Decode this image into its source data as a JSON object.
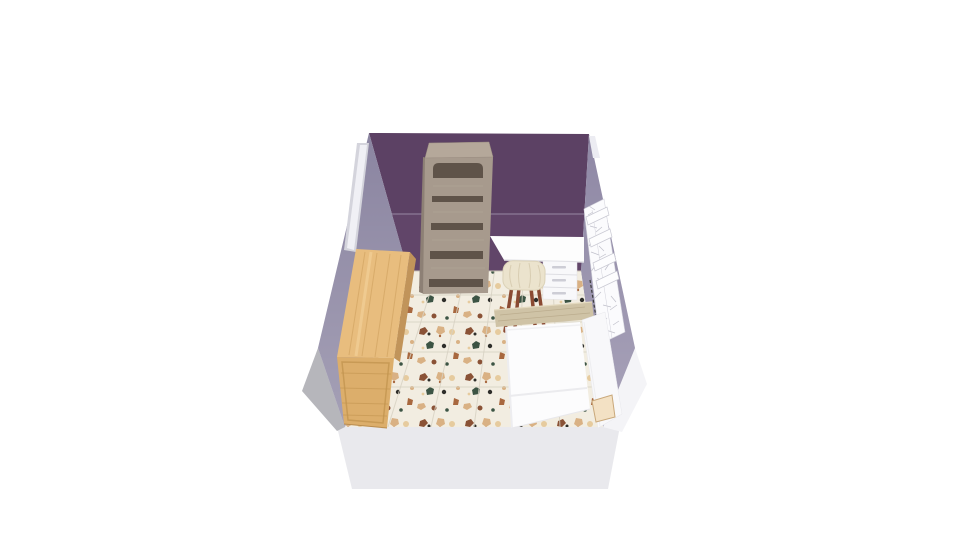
{
  "scene": {
    "description": "3D room-planner perspective view of a small bedroom seen from above, on a white canvas",
    "room": {
      "back_wall": "dark purple accent wall with horizontal trim line",
      "side_walls": "muted grey-lavender",
      "floor": "terrazzo tile with brown, tan, peach and green speckles",
      "front_wall": "white cutaway wall facing the camera"
    },
    "objects": [
      {
        "id": "door",
        "label": "white door on left wall near back corner"
      },
      {
        "id": "dresser",
        "label": "tall light-oak dresser against left wall"
      },
      {
        "id": "bookshelf",
        "label": "tall taupe bookshelf against back wall"
      },
      {
        "id": "desk",
        "label": "white desk with three-drawer unit against back wall"
      },
      {
        "id": "stool",
        "label": "cream upholstered stool with wooden legs"
      },
      {
        "id": "bed",
        "label": "white single bed with wooden headboard and foot"
      },
      {
        "id": "wall-shelf",
        "label": "white sketched shelf unit on right wall with boxes on top"
      }
    ],
    "colors": {
      "background": "#ffffff",
      "back_wall": "#5c4164",
      "back_wall_lower": "#614569",
      "back_wall_trim": "#8d7b97",
      "side_wall_left": "#8b85a1",
      "side_wall_right": "#8f88a5",
      "front_wall": "#e9e9ed",
      "front_wall_left_shade": "#b6b6bb",
      "front_wall_right_light": "#f4f4f7",
      "floor_base": "#f2ede1",
      "door_frame": "#d4d4dc",
      "door_panel": "#f0f0f5",
      "corner_strip": "#ececf2",
      "bookshelf_front": "#a79a8d",
      "bookshelf_top": "#b5a89a",
      "bookshelf_side": "#8d8075",
      "bookshelf_opening": "#5f5349",
      "dresser_top": "#e8bd7e",
      "dresser_front": "#dcae6b",
      "dresser_side": "#c1945a",
      "desk_top": "#fdfdfd",
      "drawer_unit": "#f8f8fa",
      "drawer_handle": "#cdcdd5",
      "stool_seat": "#ebe3cd",
      "stool_leg": "#8a4a32",
      "bed_headboard": "#cfc3a6",
      "mattress": "#fcfcfd",
      "bed_rail": "#f8f8fa",
      "bed_foot": "#f3e1c4",
      "wall_unit": "#fbfbfd",
      "wall_unit_box": "#fdfdfe",
      "speckle_brown": "#8a5236",
      "speckle_tan": "#d9b184",
      "speckle_peach": "#e6cb9e",
      "speckle_green": "#3c5444",
      "speckle_dark": "#2e2e2a",
      "speckle_rust": "#a8683f"
    }
  }
}
